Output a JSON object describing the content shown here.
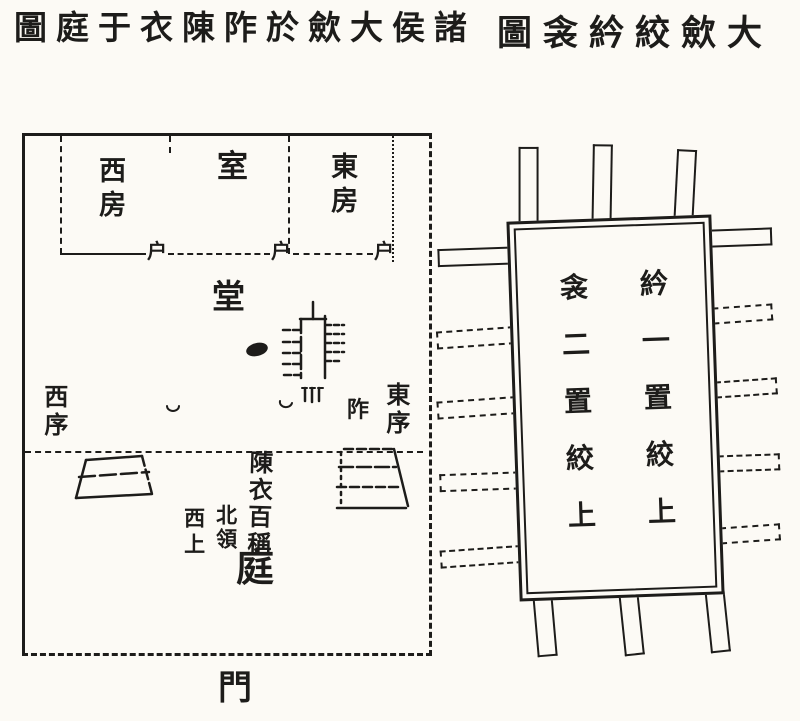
{
  "paper": {
    "background": "#fcfaf5",
    "ink_color": "#1d1c1a"
  },
  "titles": {
    "left_display": "圖庭于衣陳阼於歛大侯諸",
    "left_reading_right_to_left": "諸侯大歛於阼陳衣于庭圖",
    "right_display": "圖衾紟絞歛大",
    "right_reading_right_to_left": "大歛絞紟衾圖"
  },
  "hall_plan": {
    "west_chamber": "西房",
    "central_chamber": "室",
    "east_chamber": "東房",
    "door_labels": [
      "户",
      "户",
      "户"
    ],
    "hall": "堂",
    "west_wall": "西序",
    "east_wall": "東序",
    "eastern_steps": "阼",
    "clothes_note": "陳衣百稱",
    "collars_north": "北領",
    "west_first": "西上",
    "courtyard": "庭",
    "gate": "門"
  },
  "shroud_diagram": {
    "column_right": "紟一置絞上",
    "column_left": "衾二置絞上"
  }
}
